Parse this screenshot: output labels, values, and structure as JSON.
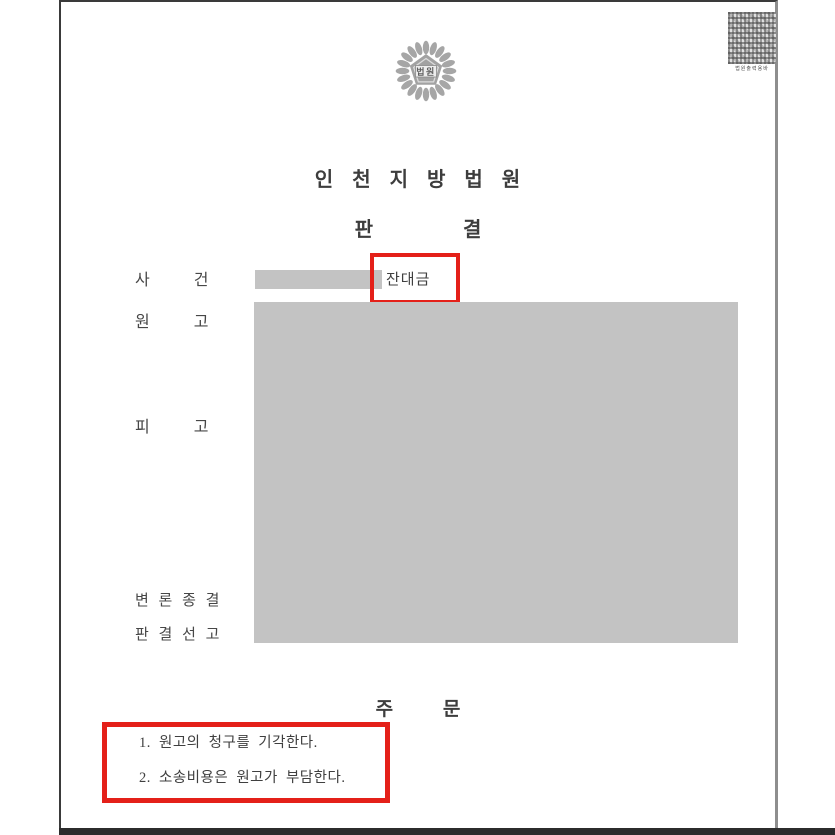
{
  "page": {
    "emblem_label": "법원",
    "barcode_caption": "법원출력용바",
    "court_name": "인 천 지 방 법 원",
    "doc_title": "판 결",
    "rows": {
      "case_label": "사 건",
      "case_value": "잔대금",
      "plaintiff_label": "원 고",
      "defendant_label": "피 고",
      "closing_label": "변 론 종 결",
      "sentencing_label": "판 결 선 고"
    },
    "order": {
      "header": "주 문",
      "items": [
        "1. 원고의 청구를 기각한다.",
        "2. 소송비용은 원고가 부담한다."
      ]
    },
    "colors": {
      "redaction_gray": "#c3c3c3",
      "annotation_red": "#e42019",
      "text_dark": "#3f3f3f"
    }
  }
}
